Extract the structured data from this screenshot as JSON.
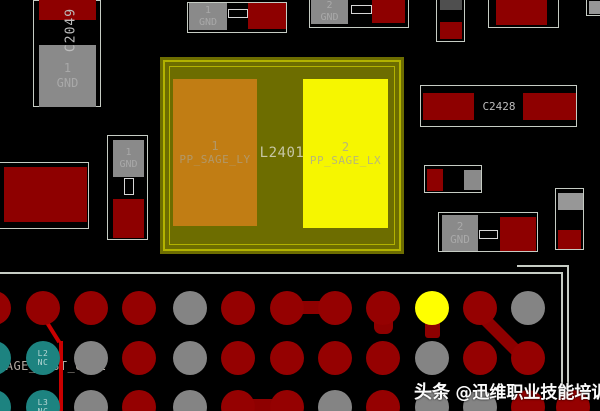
{
  "inductor": {
    "refdes": "L2401",
    "pad1_num": "1",
    "pad1_net": "PP_SAGE_LY",
    "pad2_num": "2",
    "pad2_net": "PP_SAGE_LX"
  },
  "components": {
    "c2049": {
      "refdes": "C2049",
      "pin_num": "1",
      "pin_net": "GND"
    },
    "top_cap1": {
      "pin_num": "1",
      "pin_net": "GND"
    },
    "top_cap2": {
      "pin_num": "2",
      "pin_net": "GND"
    },
    "vbst": {
      "pin_num": "2",
      "net": "SAGE_VBST_OUTL"
    },
    "left_vert": {
      "pin_num": "1",
      "pin_net": "GND"
    },
    "c2428": {
      "refdes": "C2428"
    },
    "right_gnd": {
      "pin_num": "2",
      "pin_net": "GND"
    }
  },
  "watermark": {
    "brand": "头条",
    "handle": "@迅维职业技能培训"
  },
  "bga": {
    "balls": [
      {
        "x": -6,
        "y": 308,
        "c": "red"
      },
      {
        "x": 43,
        "y": 308,
        "c": "red"
      },
      {
        "x": 91,
        "y": 308,
        "c": "red"
      },
      {
        "x": 139,
        "y": 308,
        "c": "red"
      },
      {
        "x": 190,
        "y": 308,
        "c": "gray"
      },
      {
        "x": 238,
        "y": 308,
        "c": "red"
      },
      {
        "x": 287,
        "y": 308,
        "c": "red"
      },
      {
        "x": 335,
        "y": 308,
        "c": "red"
      },
      {
        "x": 383,
        "y": 308,
        "c": "red"
      },
      {
        "x": 432,
        "y": 308,
        "c": "yellow"
      },
      {
        "x": 480,
        "y": 308,
        "c": "red"
      },
      {
        "x": 528,
        "y": 308,
        "c": "gray"
      },
      {
        "x": -6,
        "y": 358,
        "c": "teal"
      },
      {
        "x": 43,
        "y": 358,
        "c": "teal",
        "l": [
          "L2",
          "NC"
        ]
      },
      {
        "x": 91,
        "y": 358,
        "c": "gray"
      },
      {
        "x": 139,
        "y": 358,
        "c": "red"
      },
      {
        "x": 190,
        "y": 358,
        "c": "gray"
      },
      {
        "x": 238,
        "y": 358,
        "c": "red"
      },
      {
        "x": 287,
        "y": 358,
        "c": "red"
      },
      {
        "x": 335,
        "y": 358,
        "c": "red"
      },
      {
        "x": 383,
        "y": 358,
        "c": "red"
      },
      {
        "x": 432,
        "y": 358,
        "c": "gray"
      },
      {
        "x": 480,
        "y": 358,
        "c": "red"
      },
      {
        "x": 528,
        "y": 358,
        "c": "red"
      },
      {
        "x": -6,
        "y": 407,
        "c": "teal"
      },
      {
        "x": 43,
        "y": 407,
        "c": "teal",
        "l": [
          "L3",
          "NC"
        ]
      },
      {
        "x": 91,
        "y": 407,
        "c": "gray"
      },
      {
        "x": 139,
        "y": 407,
        "c": "red"
      },
      {
        "x": 190,
        "y": 407,
        "c": "gray"
      },
      {
        "x": 238,
        "y": 407,
        "c": "red"
      },
      {
        "x": 287,
        "y": 407,
        "c": "red"
      },
      {
        "x": 335,
        "y": 407,
        "c": "gray"
      },
      {
        "x": 383,
        "y": 407,
        "c": "red"
      },
      {
        "x": 432,
        "y": 407,
        "c": "gray"
      },
      {
        "x": 480,
        "y": 407,
        "c": "gray"
      },
      {
        "x": 528,
        "y": 407,
        "c": "red"
      },
      {
        "x": 573,
        "y": 407,
        "c": "red"
      }
    ],
    "traces": [
      {
        "x": 287,
        "y": 301,
        "w": 48,
        "h": 13,
        "c": "dark"
      },
      {
        "x": 238,
        "y": 399,
        "w": 50,
        "h": 13,
        "c": "dark"
      },
      {
        "x": 476,
        "y": 302,
        "w": 72,
        "h": 12,
        "rot": 45,
        "c": "dark"
      },
      {
        "x": 374,
        "y": 314,
        "w": 19,
        "h": 20,
        "rad": 7,
        "c": "dark"
      },
      {
        "x": 425,
        "y": 320,
        "w": 15,
        "h": 18,
        "rad": 3,
        "c": "dark"
      },
      {
        "x": 44,
        "y": 314,
        "w": 32,
        "h": 4,
        "rot": 58,
        "c": "bright"
      },
      {
        "x": 59,
        "y": 341,
        "w": 4,
        "h": 70,
        "c": "bright"
      }
    ]
  },
  "colors": {
    "background": "#000000",
    "red_pad": "#8e0000",
    "ball_red": "#950101",
    "ball_gray": "#848484",
    "ball_teal": "#1d8380",
    "ball_yellow": "#ffff00",
    "trace_dark": "#8e0000",
    "trace_bright": "#c90000",
    "pad_gray": "#8a8a8a",
    "pad_darkgray": "#4f4f4f",
    "olive": "#6d6d00",
    "olive_line": "#b2b200",
    "orange_pad": "#c17d14",
    "yellow_pad": "#f6f600",
    "outline": "#c6ccc4",
    "board_line": "#c6ccc4",
    "pad_text": "#a9a9a9",
    "label_text": "#bcbcbc"
  }
}
